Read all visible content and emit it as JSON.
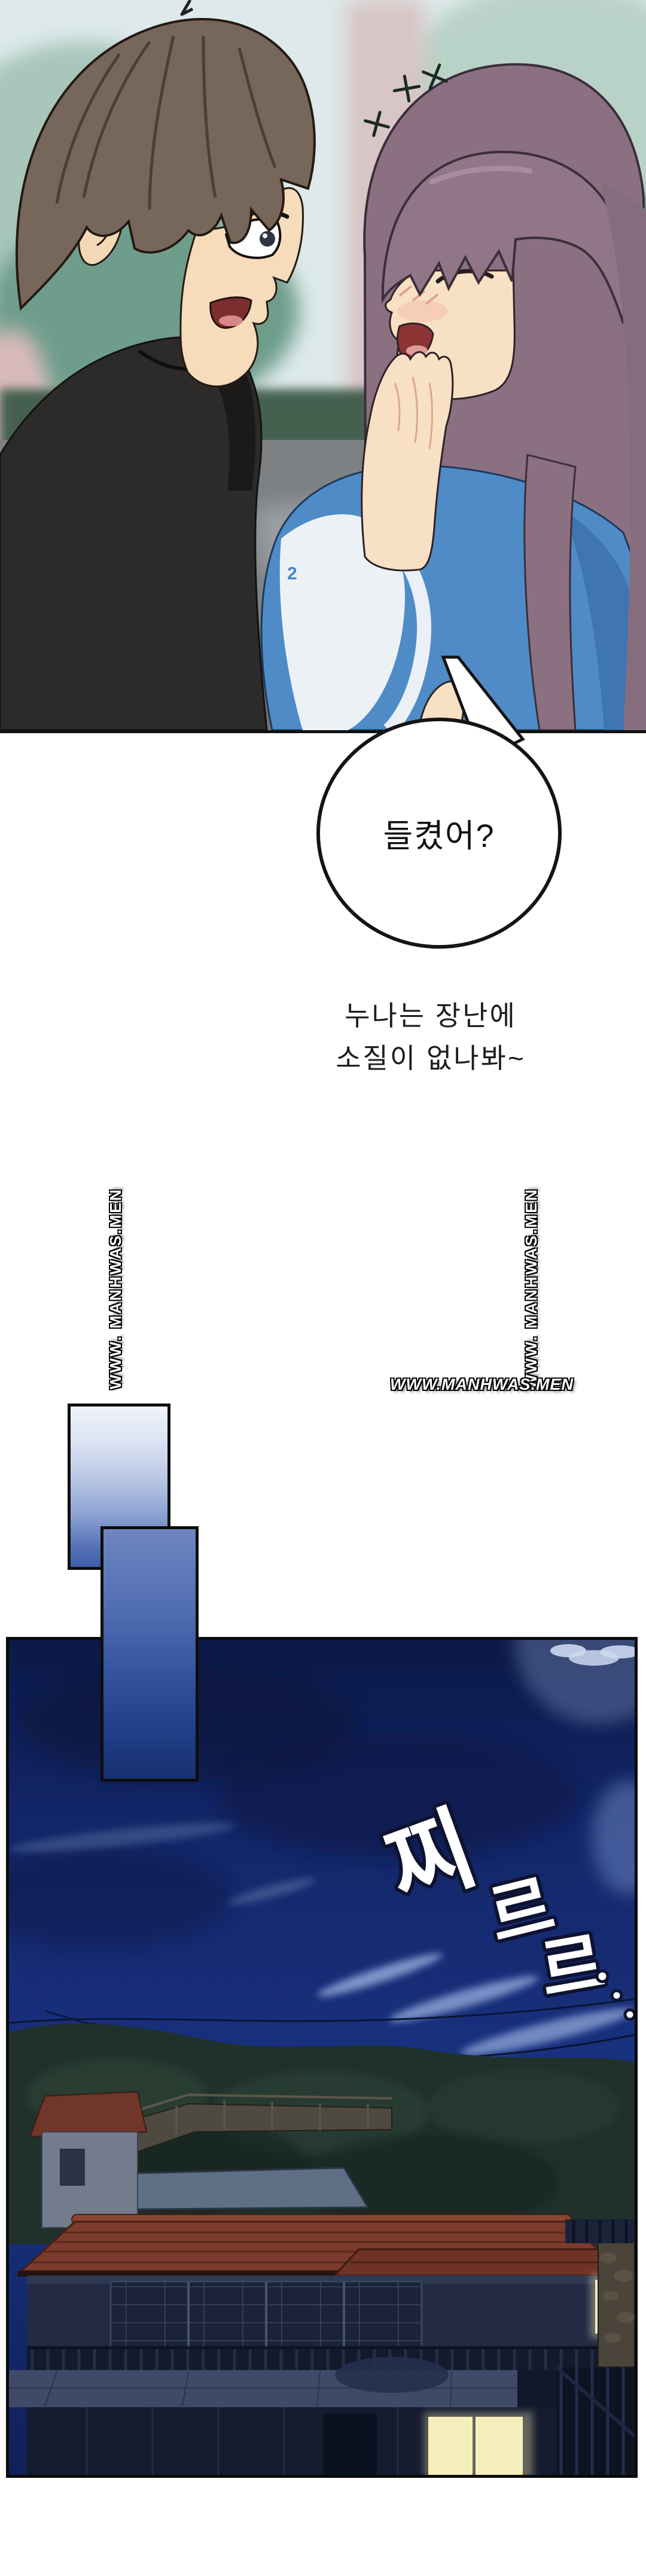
{
  "speech_bubble": {
    "text": "들켰어?"
  },
  "caption": {
    "lines": [
      "누나는 장난에",
      "소질이 없나봐~"
    ]
  },
  "watermarks": {
    "vertical_left": "WWW. MANHWAS.MEN",
    "vertical_right": "WWW. MANHWAS.MEN",
    "horizontal": "WWW.MANHWAS.MEN"
  },
  "sfx": {
    "chars": [
      "찌",
      "르",
      "르"
    ],
    "trail_dots": 3
  },
  "characters": {
    "man": {
      "hair_color": "#77675a",
      "shirt_color": "#2c2b29"
    },
    "woman": {
      "hair_color": "#8a7081",
      "shirt_color": "#4f8cc7",
      "shirt_print": "2"
    }
  },
  "scene_colors": {
    "sky_top": "#0b1947",
    "sky_mid": "#1b3384",
    "roof": "#7c3b2c",
    "lit_window": "#f6efbb",
    "street": "#7e8183",
    "hedge": "#44604f"
  }
}
